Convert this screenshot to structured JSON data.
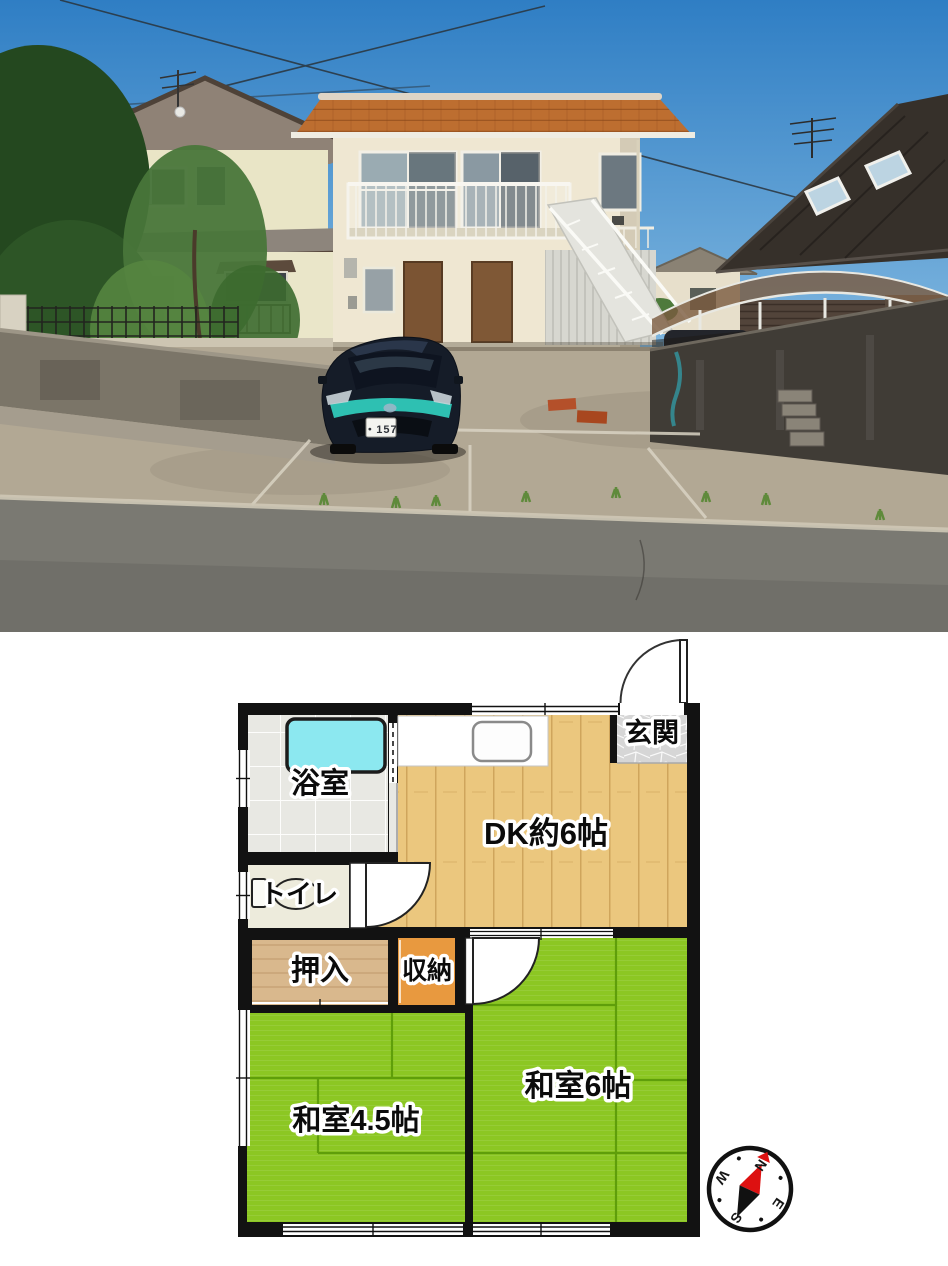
{
  "photo": {
    "car": {
      "license_plate": "・157",
      "body_color": "#151c28",
      "accent_color": "#2fc9b9"
    },
    "colors": {
      "sky_top": "#2f7ec4",
      "sky_bottom": "#cfe9f6",
      "building_wall": "#efe7d2",
      "building_roof": "#bd6e30",
      "left_house_wall": "#e9e5c6",
      "right_house_roof": "#36302a",
      "pavement": "#b2a894",
      "road": "#7a7972"
    }
  },
  "floorplan": {
    "labels": {
      "bath": "浴室",
      "entrance": "玄関",
      "dining_kitchen": "DK約6帖",
      "toilet": "トイレ",
      "closet": "押入",
      "storage": "収納",
      "japanese_room_6": "和室6帖",
      "japanese_room_4_5": "和室4.5帖"
    },
    "compass": {
      "north": "N",
      "east": "E",
      "south": "S",
      "west": "W"
    },
    "colors": {
      "wall": "#121212",
      "tatami": "#8cc723",
      "tatami_line": "#5f9e0a",
      "wood_floor": "#ebc77e",
      "closet": "#d9b88d",
      "storage": "#e8993f",
      "bathtub": "#8ce8f0",
      "bath_tile": "#e8e8e3",
      "toilet_floor": "#edebdc",
      "entrance_tile": "#d6d6d6",
      "compass_red": "#dd1111"
    }
  }
}
